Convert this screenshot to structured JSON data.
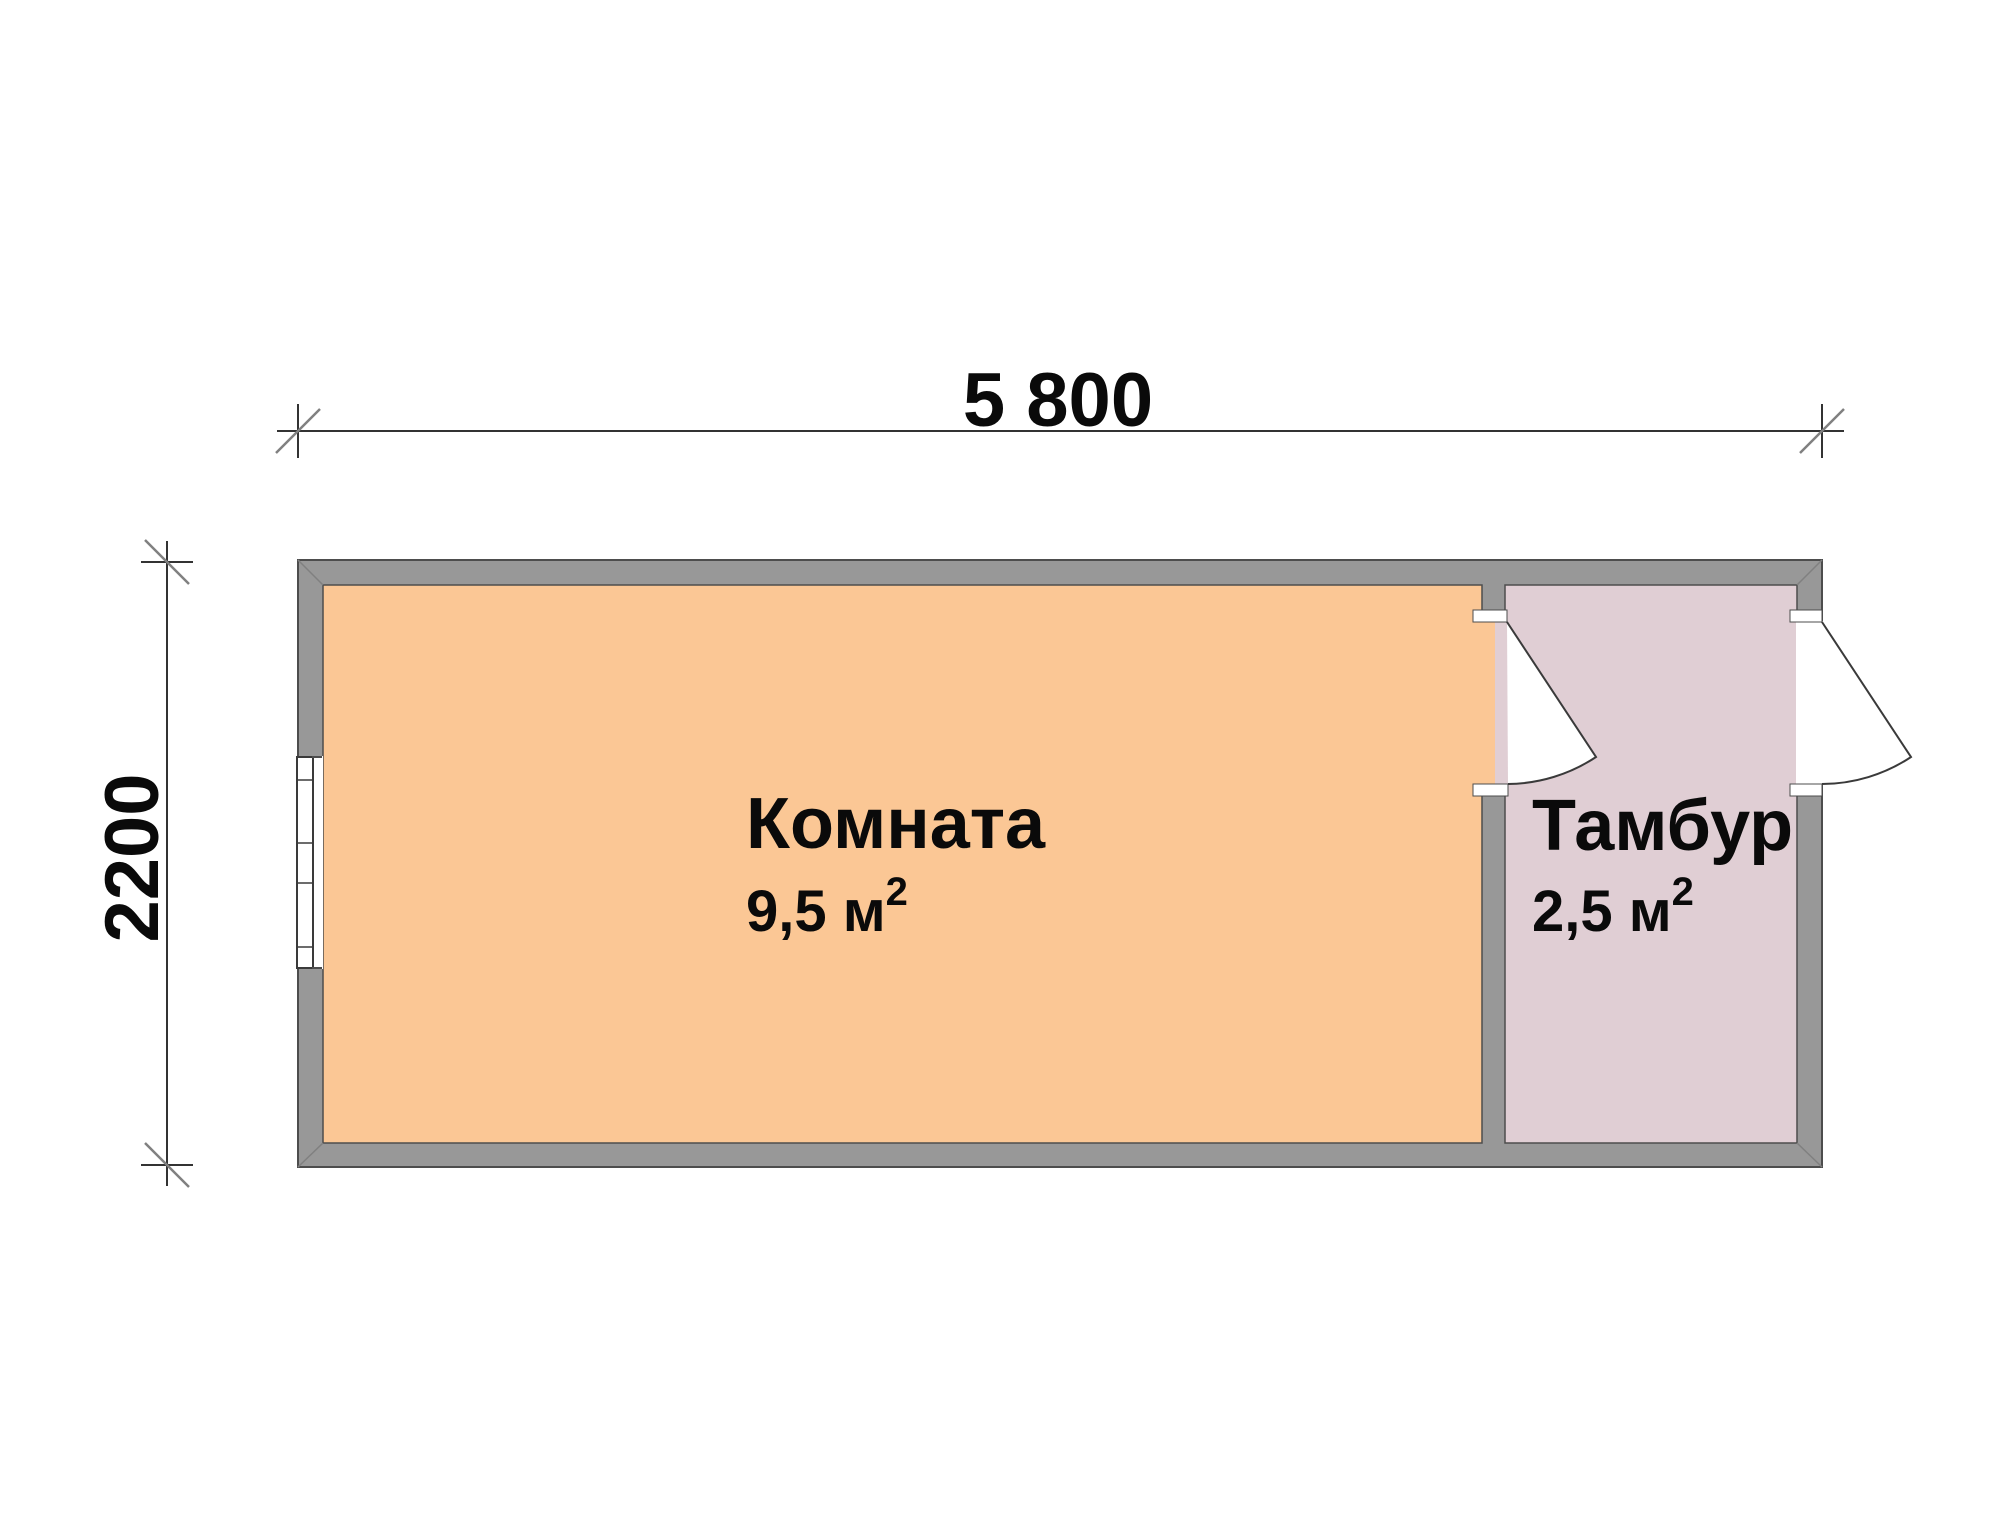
{
  "dimensions": {
    "width_label": "5 800",
    "height_label": "2200"
  },
  "rooms": [
    {
      "name": "Комната",
      "area": "9,5 м",
      "area_sup": "2"
    },
    {
      "name": "Тамбур",
      "area": "2,5 м",
      "area_sup": "2"
    }
  ],
  "colors": {
    "room_fill": "#FBC795",
    "vestibule_fill": "#E0CED4",
    "wall_fill": "#989898"
  }
}
